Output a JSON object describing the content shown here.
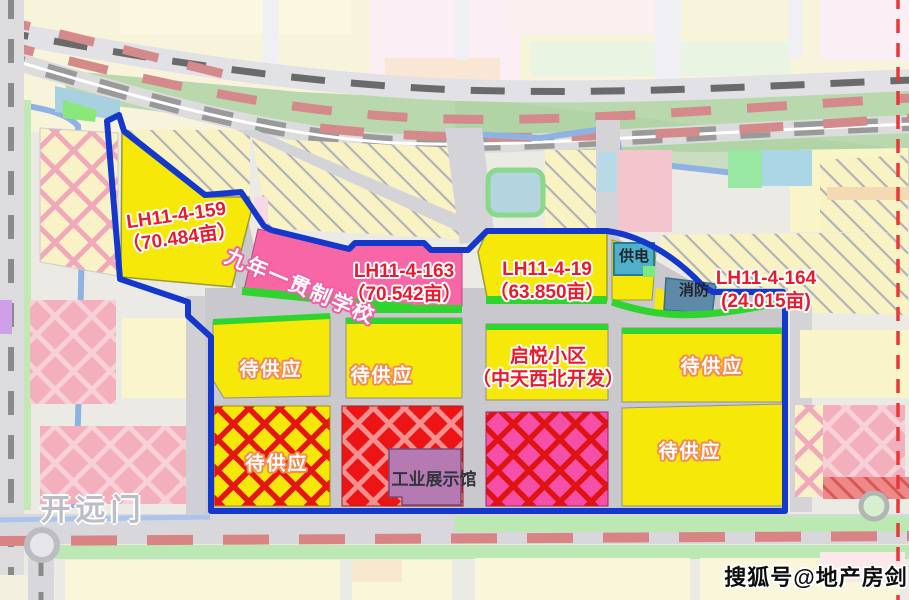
{
  "parcels": {
    "lh159": {
      "id": "LH11-4-159",
      "area": "（70.484亩）"
    },
    "school": {
      "name": "九年一贯制学校"
    },
    "lh163": {
      "id": "LH11-4-163",
      "area": "（70.542亩）"
    },
    "lh19": {
      "id": "LH11-4-19",
      "area": "（63.850亩）"
    },
    "lh164": {
      "id": "LH11-4-164",
      "area": "(24.015亩)"
    },
    "pending_label": "待供应",
    "qiyue": {
      "name": "启悦小区",
      "developer": "（中天西北开发）"
    },
    "exhibition_hall": "工业展示馆",
    "power_station": "供电",
    "fire_station": "消防"
  },
  "roads": {
    "kaiyuanmen": "开远门"
  },
  "watermark": "搜狐号@地产房剑",
  "colors": {
    "boundary_blue": "#1438cc",
    "parcel_yellow": "#f6e90a",
    "parcel_pink": "#f767a6",
    "label_red": "#e81a2e",
    "pending_text_glow": "#f5894f",
    "metro_dash_red": "#d88484",
    "edge_dash_red": "#e83838",
    "green_strip": "#2fd42f"
  }
}
